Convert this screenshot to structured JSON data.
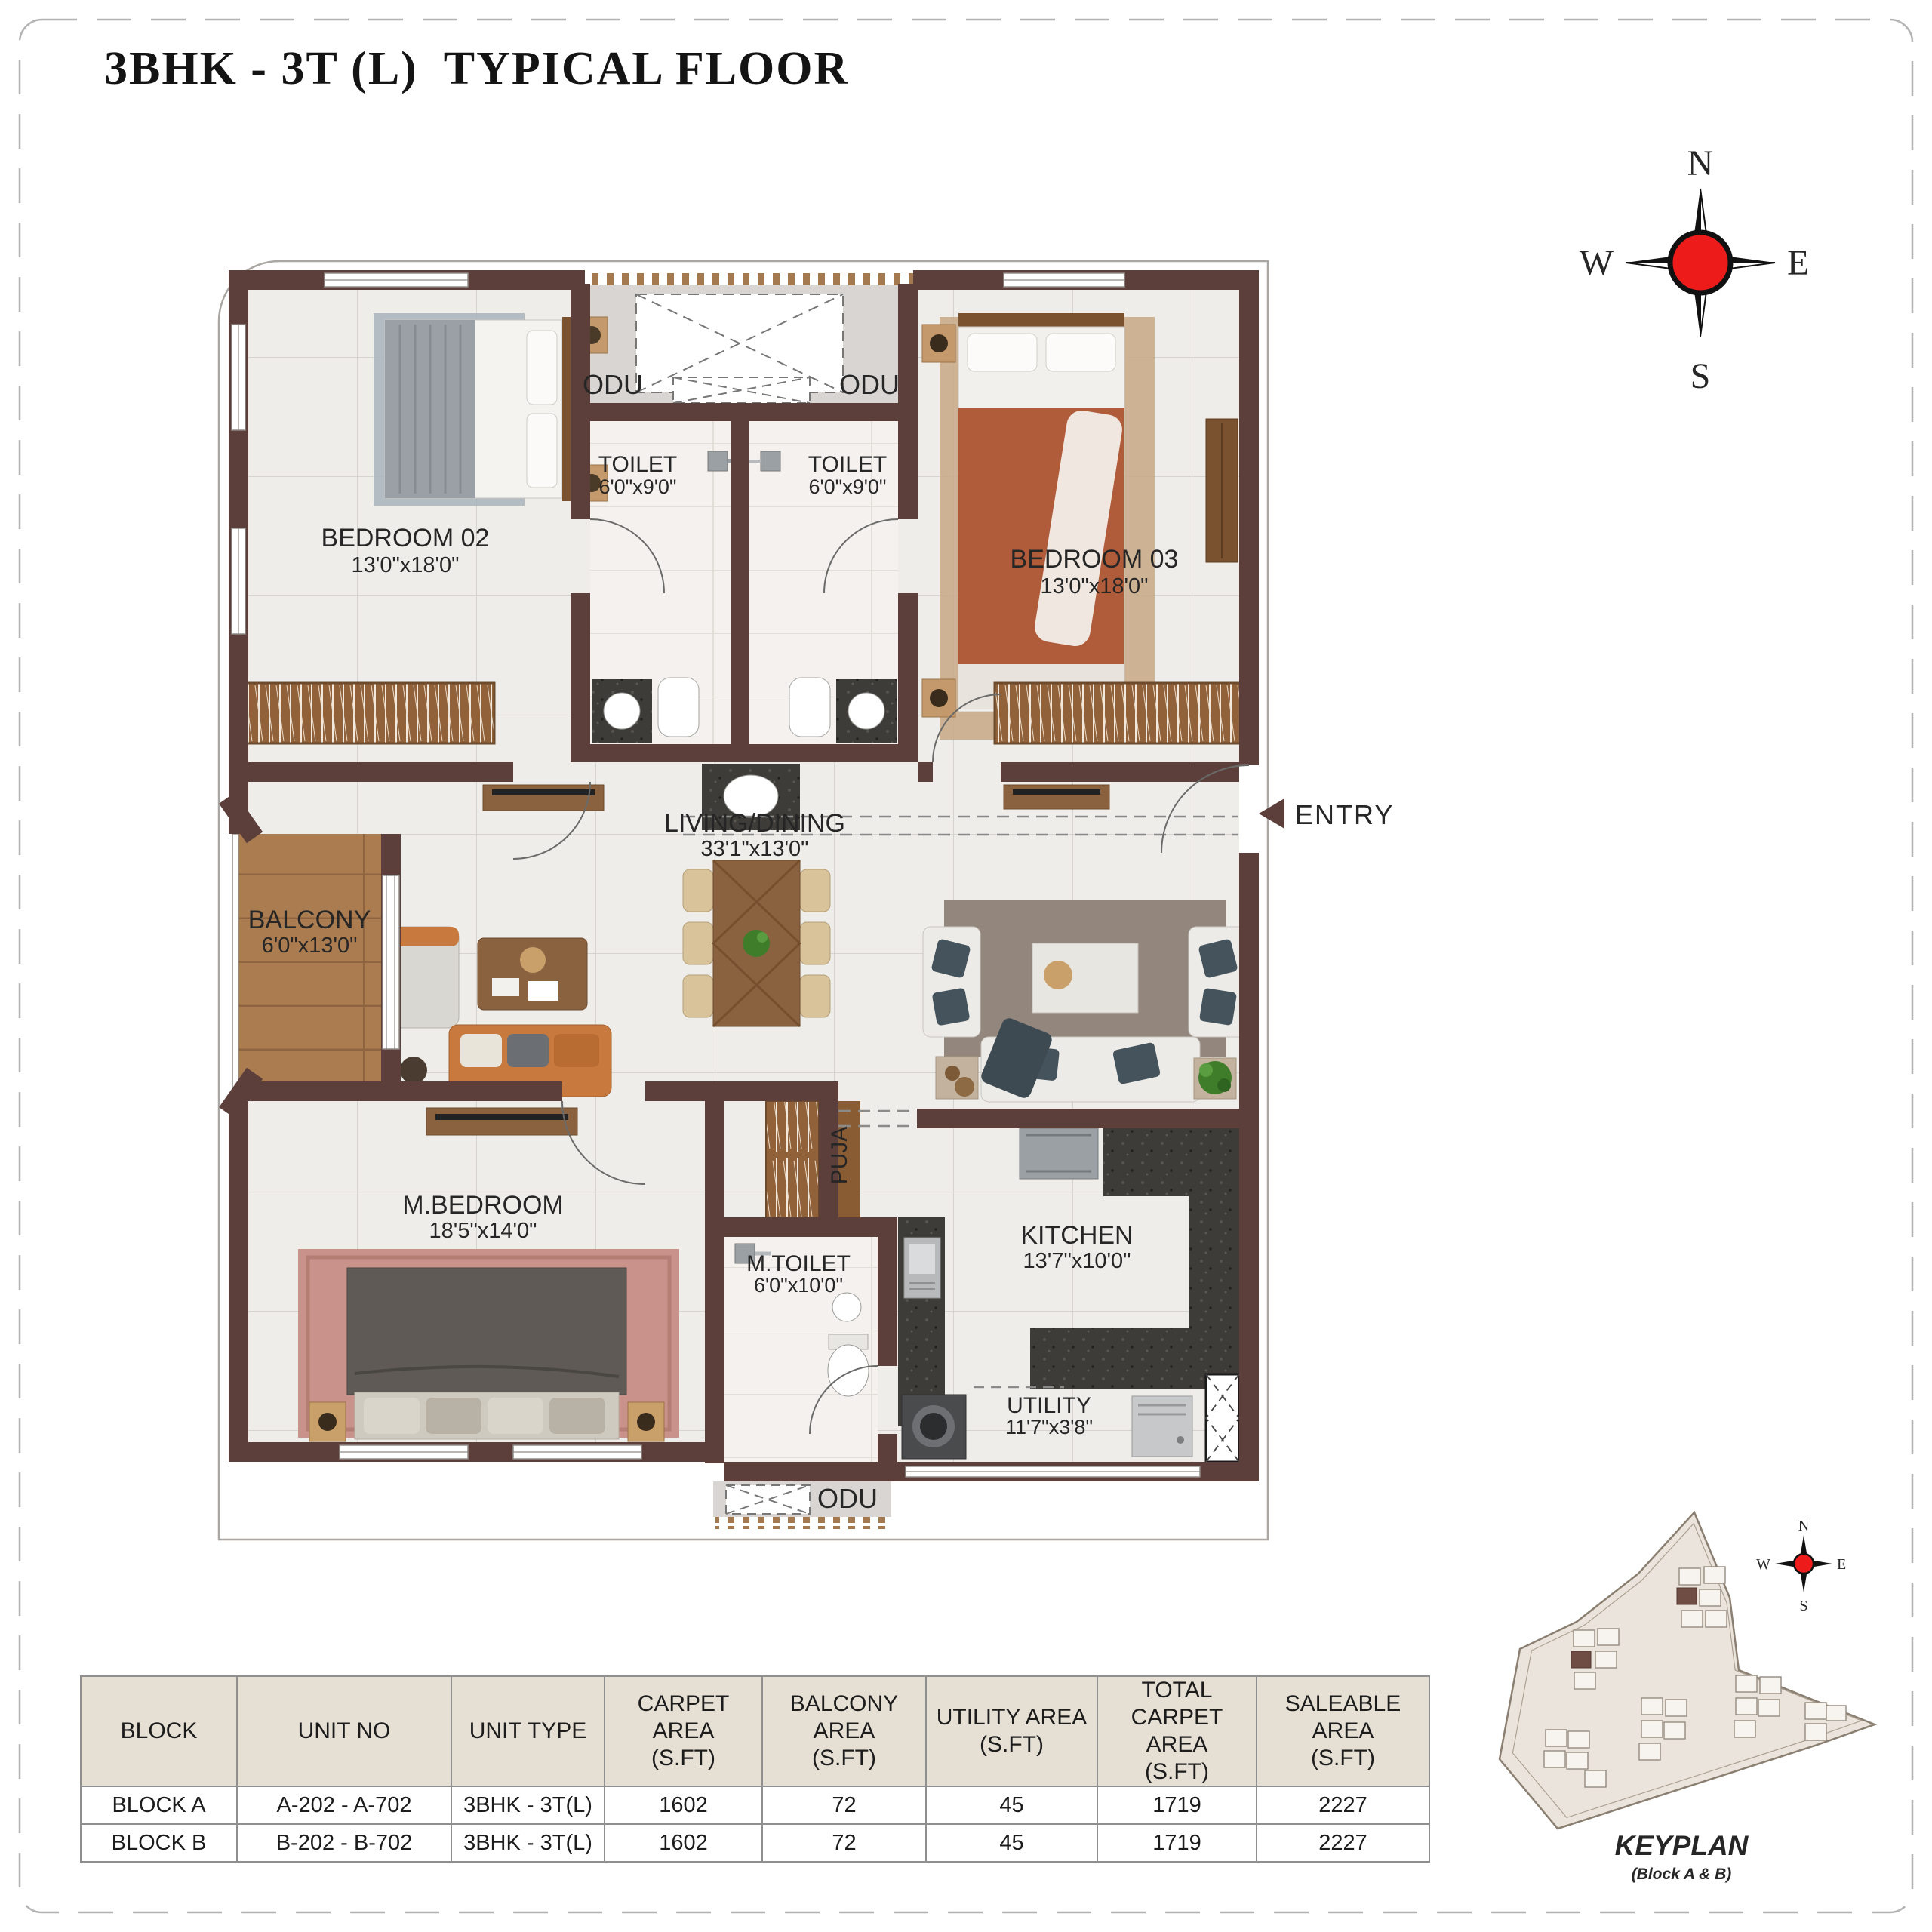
{
  "page": {
    "title": "3BHK - 3T (L)  TYPICAL FLOOR"
  },
  "compass": {
    "north": "N",
    "south": "S",
    "east": "E",
    "west": "W"
  },
  "plan": {
    "bedroom02": {
      "name": "BEDROOM 02",
      "dims": "13'0\"x18'0\""
    },
    "bedroom03": {
      "name": "BEDROOM 03",
      "dims": "13'0\"x18'0\""
    },
    "toilet2": {
      "name": "TOILET",
      "dims": "6'0\"x9'0\""
    },
    "toilet3": {
      "name": "TOILET",
      "dims": "6'0\"x9'0\""
    },
    "living": {
      "name": "LIVING/DINING",
      "dims": "33'1\"x13'0\""
    },
    "balcony": {
      "name": "BALCONY",
      "dims": "6'0\"x13'0\""
    },
    "master_bedroom": {
      "name": "M.BEDROOM",
      "dims": "18'5\"x14'0\""
    },
    "master_toilet": {
      "name": "M.TOILET",
      "dims": "6'0\"x10'0\""
    },
    "kitchen": {
      "name": "KITCHEN",
      "dims": "13'7\"x10'0\""
    },
    "utility": {
      "name": "UTILITY",
      "dims": "11'7\"x3'8\""
    },
    "puja": {
      "name": "PUJA"
    },
    "odu_top_left": "ODU",
    "odu_top_right": "ODU",
    "odu_bottom": "ODU",
    "entry": "ENTRY"
  },
  "area_table": {
    "headers": [
      "BLOCK",
      "UNIT NO",
      "UNIT TYPE",
      "CARPET AREA\n(S.FT)",
      "BALCONY AREA\n(S.FT)",
      "UTILITY AREA\n(S.FT)",
      "TOTAL\nCARPET AREA\n(S.FT)",
      "SALEABLE AREA\n(S.FT)"
    ],
    "rows": [
      [
        "BLOCK A",
        "A-202 - A-702",
        "3BHK - 3T(L)",
        "1602",
        "72",
        "45",
        "1719",
        "2227"
      ],
      [
        "BLOCK B",
        "B-202 - B-702",
        "3BHK - 3T(L)",
        "1602",
        "72",
        "45",
        "1719",
        "2227"
      ]
    ]
  },
  "keyplan": {
    "title": "KEYPLAN",
    "subtitle": "(Block A & B)",
    "compass": {
      "north": "N",
      "south": "S",
      "east": "E",
      "west": "W"
    }
  },
  "colors": {
    "wall": "#5c3f3b",
    "compass_red": "#ee1b1b",
    "table_header_bg": "#e6dfd4"
  }
}
